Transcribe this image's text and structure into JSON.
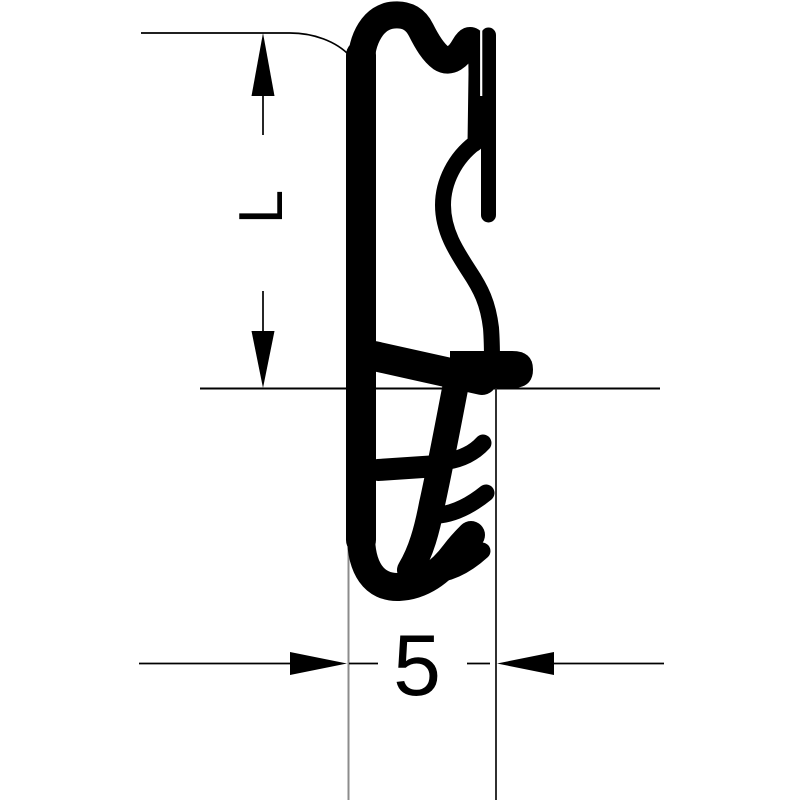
{
  "drawing": {
    "type": "technical-dimension-drawing",
    "subject": "seal-profile-cross-section",
    "dimensions": {
      "vertical_label": "L",
      "horizontal_label": "5"
    },
    "colors": {
      "ink": "#000000",
      "extension_line_left": "#8c8c8c",
      "extension_line_right": "#1a1a1a",
      "background": "#ffffff"
    }
  }
}
